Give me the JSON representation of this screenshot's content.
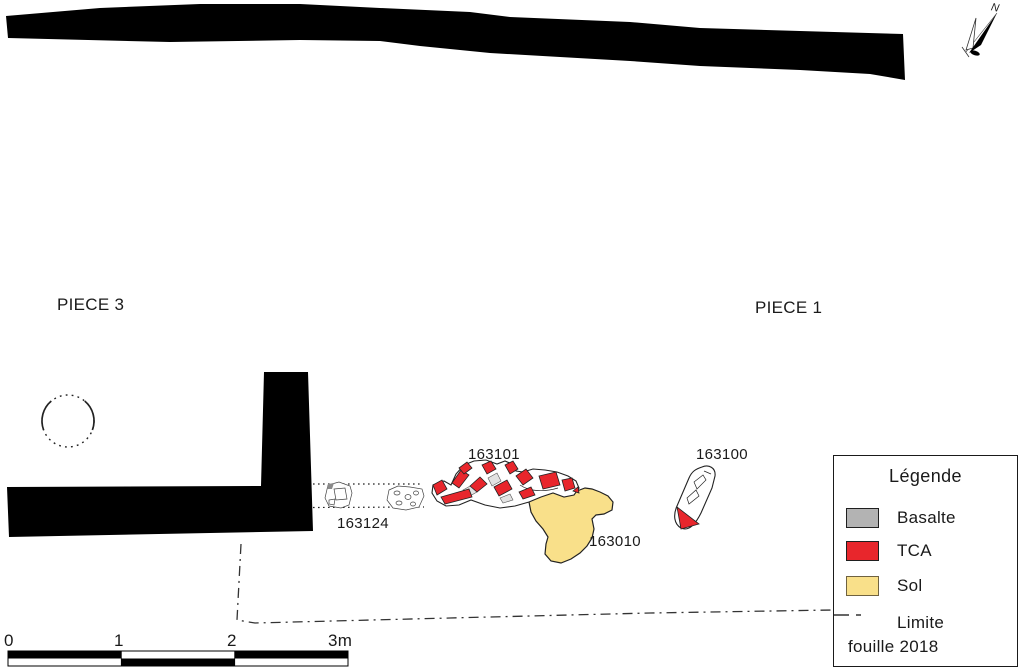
{
  "colors": {
    "wall": "#000000",
    "basalte": "#b3b3b3",
    "tca": "#e8262c",
    "sol": "#f9e08a",
    "outline": "#222222",
    "boundary": "#333333"
  },
  "rooms": {
    "piece3": "PIECE 3",
    "piece1": "PIECE 1"
  },
  "features": {
    "f163101": "163101",
    "f163124": "163124",
    "f163010": "163010",
    "f163100": "163100"
  },
  "north": {
    "label": "N"
  },
  "scalebar": {
    "ticks": [
      "0",
      "1",
      "2",
      "3m"
    ]
  },
  "legend": {
    "title": "Légende",
    "items": [
      {
        "label": "Basalte",
        "color_key": "basalte"
      },
      {
        "label": "TCA",
        "color_key": "tca"
      },
      {
        "label": "Sol",
        "color_key": "sol"
      }
    ],
    "limite_label": "Limite",
    "limite_label2": "fouille 2018"
  }
}
